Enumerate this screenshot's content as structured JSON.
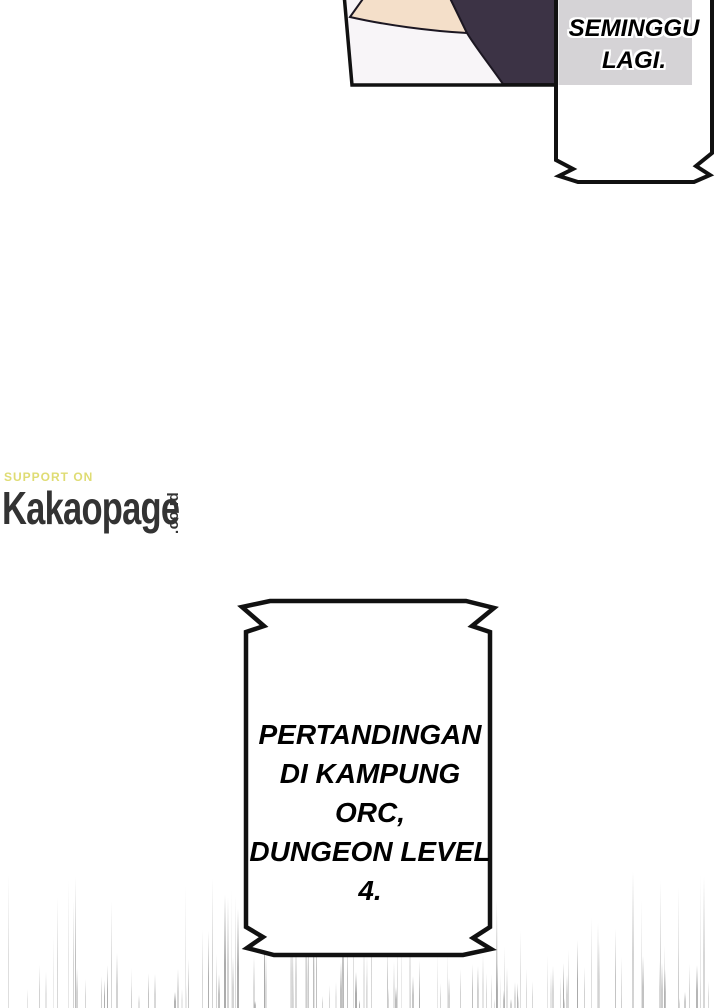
{
  "page": {
    "type": "webtoon-page",
    "background": "#ffffff"
  },
  "colors": {
    "ink": "#111111",
    "panel_bg": "#f8f5f8",
    "skin": "#f4dfc9",
    "hair_navy": "#3c3345",
    "bubble_fill": "#ffffff",
    "gray_panel": "#d5d3d6",
    "watermark_support": "#dfdc73",
    "watermark_brand": "#333333",
    "speedline_light": "#cccccc",
    "speedline_dark": "#a0a0a0"
  },
  "bubbles": {
    "top": {
      "lines": [
        "SEMINGGU",
        "LAGI."
      ]
    },
    "main": {
      "lines": [
        "PERTANDINGAN",
        "DI KAMPUNG ORC,",
        "DUNGEON LEVEL 4."
      ]
    }
  },
  "watermark": {
    "support": "SUPPORT ON",
    "brand": "Kakaopage",
    "domain": ".co.id"
  },
  "speed_lines": {
    "seed": 7,
    "region_top": 868,
    "region_bottom": 1008,
    "count_long": 75,
    "count_short": 70
  }
}
